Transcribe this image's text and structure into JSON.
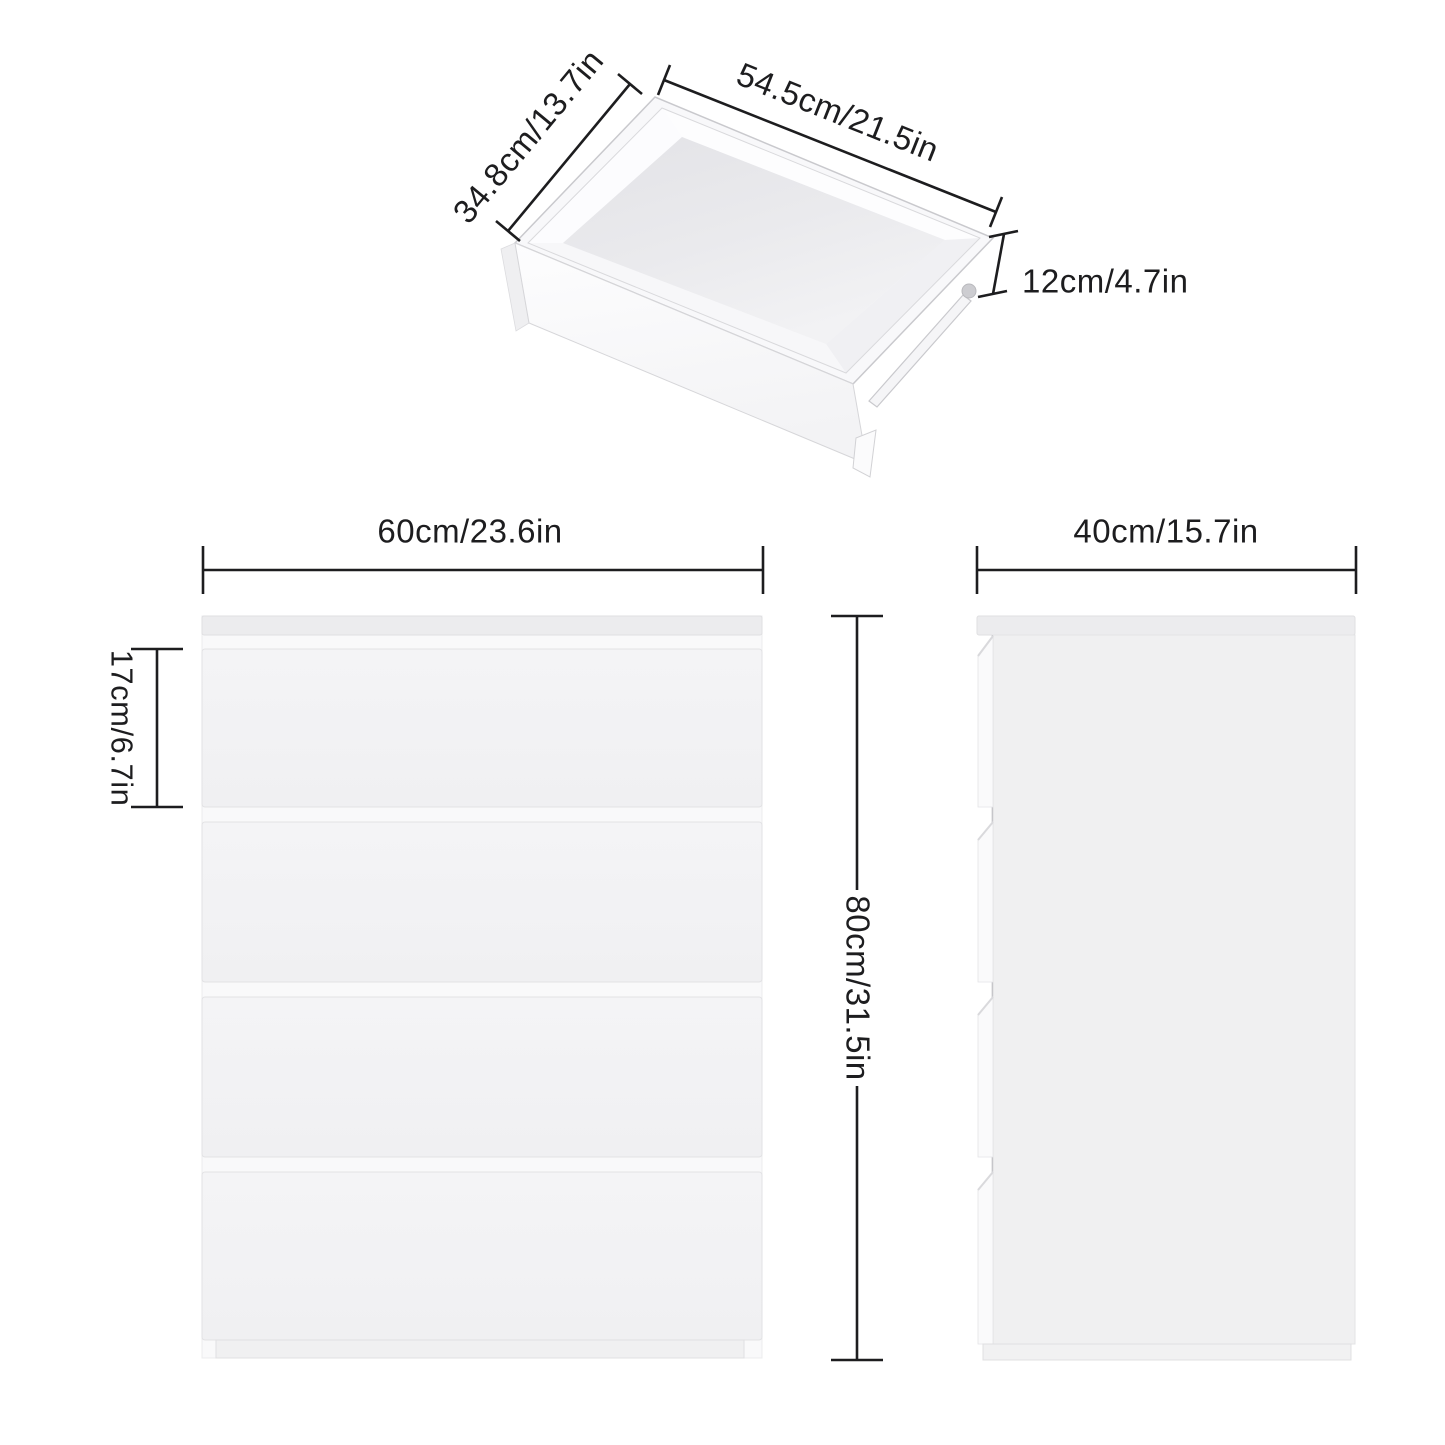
{
  "diagram": {
    "background_color": "#ffffff",
    "line_color": "#1d1d1f",
    "panel_color": "#f2f2f4",
    "top_panel_color": "#ececee",
    "labels": {
      "drawer_inner_depth": "34.8cm/13.7in",
      "drawer_inner_width": "54.5cm/21.5in",
      "drawer_inner_height": "12cm/4.7in",
      "cabinet_width": "60cm/23.6in",
      "drawer_front_height": "17cm/6.7in",
      "cabinet_height": "80cm/31.5in",
      "cabinet_depth": "40cm/15.7in"
    }
  }
}
